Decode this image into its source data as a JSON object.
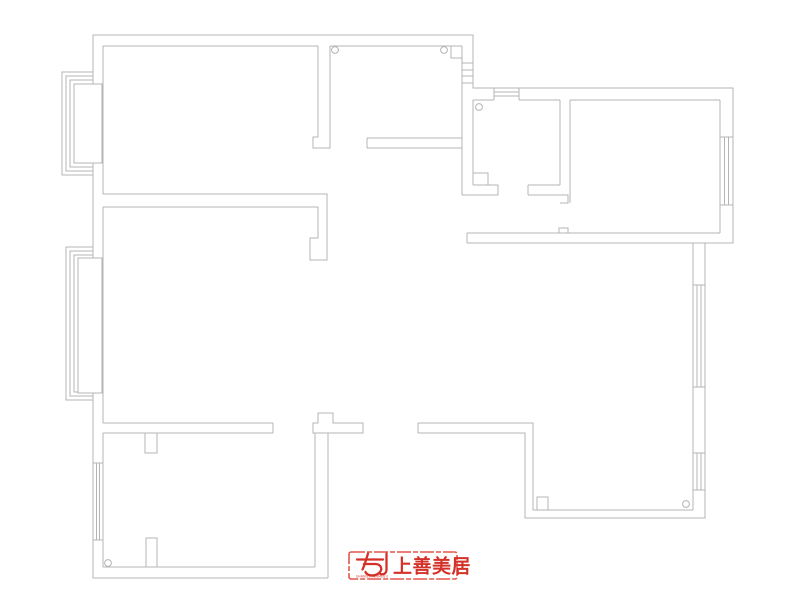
{
  "plan": {
    "description": "apartment floor plan line drawing",
    "line_color": "#b4b4b4",
    "background": "#ffffff"
  },
  "logo": {
    "brand_text": "上善美居",
    "subtext": "SHANGSHANMEIJU",
    "text_red": "#d43229",
    "border_red": "#e6574d"
  }
}
